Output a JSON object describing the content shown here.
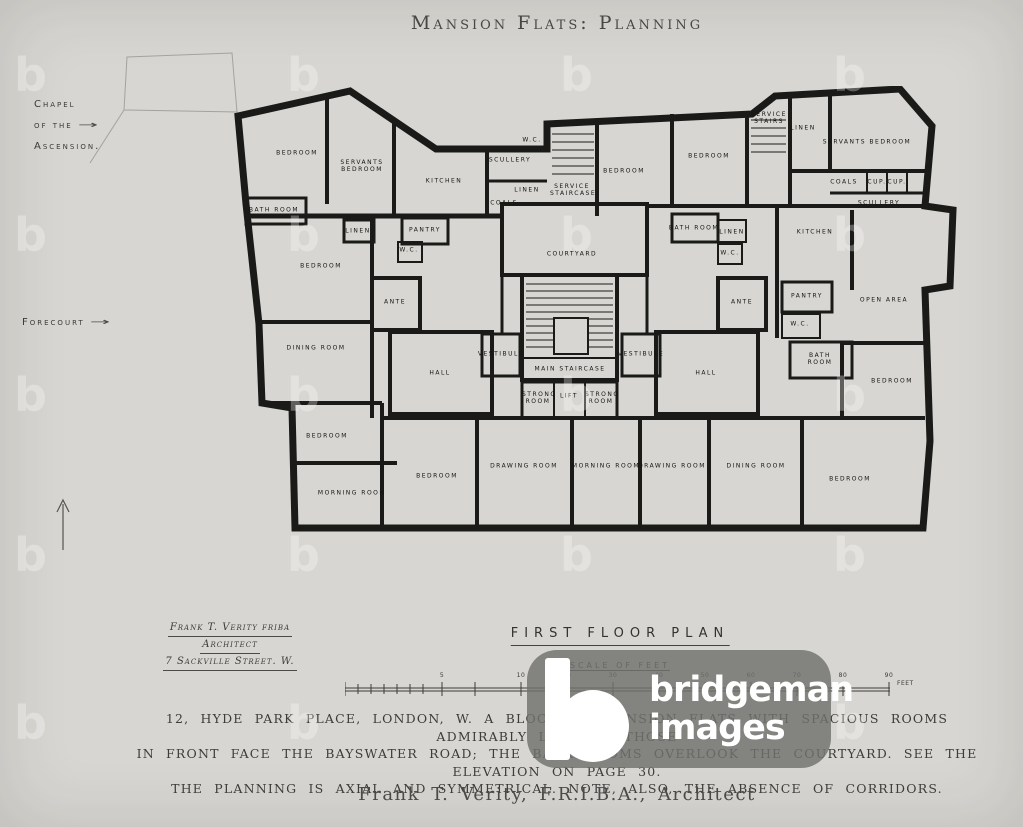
{
  "page": {
    "title": "Mansion Flats: Planning",
    "credit": "Frank T. Verity, F.R.I.B.A., Architect"
  },
  "margin_notes": {
    "chapel_line1": "Chapel",
    "chapel_line2": "of the",
    "chapel_line3": "Ascension.",
    "forecourt": "Forecourt",
    "arrow": "→"
  },
  "plan": {
    "rooms": [
      {
        "label": "BEDROOM",
        "x": 65,
        "y": 67
      },
      {
        "label": "SERVANTS BEDROOM",
        "x": 130,
        "y": 80,
        "w": 46
      },
      {
        "label": "KITCHEN",
        "x": 212,
        "y": 95
      },
      {
        "label": "SCULLERY",
        "x": 278,
        "y": 74
      },
      {
        "label": "W.C.",
        "x": 300,
        "y": 54
      },
      {
        "label": "LINEN",
        "x": 295,
        "y": 104
      },
      {
        "label": "COALS",
        "x": 272,
        "y": 117
      },
      {
        "label": "SERVICE STAIRCASE",
        "x": 340,
        "y": 104,
        "w": 44
      },
      {
        "label": "BEDROOM",
        "x": 392,
        "y": 85
      },
      {
        "label": "BEDROOM",
        "x": 477,
        "y": 70
      },
      {
        "label": "SERVICE STAIRS",
        "x": 537,
        "y": 32,
        "w": 40
      },
      {
        "label": "LINEN",
        "x": 571,
        "y": 42
      },
      {
        "label": "SERVANTS BEDROOM",
        "x": 635,
        "y": 56
      },
      {
        "label": "COALS",
        "x": 612,
        "y": 96
      },
      {
        "label": "CUP.",
        "x": 645,
        "y": 96
      },
      {
        "label": "CUP.",
        "x": 665,
        "y": 96
      },
      {
        "label": "SCULLERY",
        "x": 647,
        "y": 117
      },
      {
        "label": "BATH ROOM",
        "x": 42,
        "y": 124
      },
      {
        "label": "LINEN",
        "x": 126,
        "y": 145
      },
      {
        "label": "PANTRY",
        "x": 193,
        "y": 144
      },
      {
        "label": "W.C.",
        "x": 177,
        "y": 164
      },
      {
        "label": "BEDROOM",
        "x": 89,
        "y": 180
      },
      {
        "label": "ANTE",
        "x": 163,
        "y": 216
      },
      {
        "label": "DINING ROOM",
        "x": 84,
        "y": 262
      },
      {
        "label": "COURTYARD",
        "x": 340,
        "y": 168
      },
      {
        "label": "BATH ROOM",
        "x": 462,
        "y": 142
      },
      {
        "label": "LINEN",
        "x": 500,
        "y": 146
      },
      {
        "label": "W.C.",
        "x": 498,
        "y": 167
      },
      {
        "label": "ANTE",
        "x": 510,
        "y": 216
      },
      {
        "label": "KITCHEN",
        "x": 583,
        "y": 146
      },
      {
        "label": "PANTRY",
        "x": 575,
        "y": 210
      },
      {
        "label": "W.C.",
        "x": 568,
        "y": 238
      },
      {
        "label": "OPEN AREA",
        "x": 652,
        "y": 214
      },
      {
        "label": "VESTIBULE",
        "x": 269,
        "y": 268
      },
      {
        "label": "VESTIBULE",
        "x": 409,
        "y": 268
      },
      {
        "label": "MAIN STAIRCASE",
        "x": 338,
        "y": 283
      },
      {
        "label": "HALL",
        "x": 208,
        "y": 287
      },
      {
        "label": "HALL",
        "x": 474,
        "y": 287
      },
      {
        "label": "STRONG ROOM",
        "x": 306,
        "y": 312,
        "w": 32
      },
      {
        "label": "LIFT",
        "x": 337,
        "y": 310
      },
      {
        "label": "STRONG ROOM",
        "x": 369,
        "y": 312,
        "w": 32
      },
      {
        "label": "BATH ROOM",
        "x": 588,
        "y": 273,
        "w": 28
      },
      {
        "label": "BEDROOM",
        "x": 660,
        "y": 295
      },
      {
        "label": "BEDROOM",
        "x": 95,
        "y": 350
      },
      {
        "label": "MORNING ROOM",
        "x": 120,
        "y": 407
      },
      {
        "label": "BEDROOM",
        "x": 205,
        "y": 390
      },
      {
        "label": "DRAWING ROOM",
        "x": 292,
        "y": 380
      },
      {
        "label": "MORNING ROOM",
        "x": 374,
        "y": 380
      },
      {
        "label": "DRAWING ROOM",
        "x": 440,
        "y": 380
      },
      {
        "label": "DINING ROOM",
        "x": 524,
        "y": 380
      },
      {
        "label": "BEDROOM",
        "x": 618,
        "y": 393
      }
    ]
  },
  "footer": {
    "stamp_lines": [
      "Frank T. Verity friba",
      "Architect",
      "7 Sackville Street. W."
    ],
    "plan_title": "FIRST FLOOR PLAN",
    "scale_label": "SCALE OF FEET",
    "scale_ticks": [
      "5",
      "10",
      "20",
      "30",
      "40",
      "50",
      "60",
      "70",
      "80",
      "90"
    ],
    "scale_unit": "FEET",
    "caption_lines": [
      "12, HYDE PARK PLACE, LONDON, W. A BLOCK OF MANSION FLATS WITH SPACIOUS ROOMS ADMIRABLY LIGHTED. THOSE",
      "IN FRONT FACE THE BAYSWATER ROAD; THE BACK ROOMS OVERLOOK THE COURTYARD. SEE THE ELEVATION ON PAGE 30.",
      "THE PLANNING IS AXIAL AND SYMMETRICAL. NOTE, ALSO, THE ABSENCE OF CORRIDORS."
    ]
  },
  "watermark": {
    "tile_letter": "b",
    "brand": "bridgeman",
    "brand2": "images",
    "box_color": "#706f6d",
    "ink_color": "#1a1a18",
    "paper_color": "#d7d6d2"
  }
}
